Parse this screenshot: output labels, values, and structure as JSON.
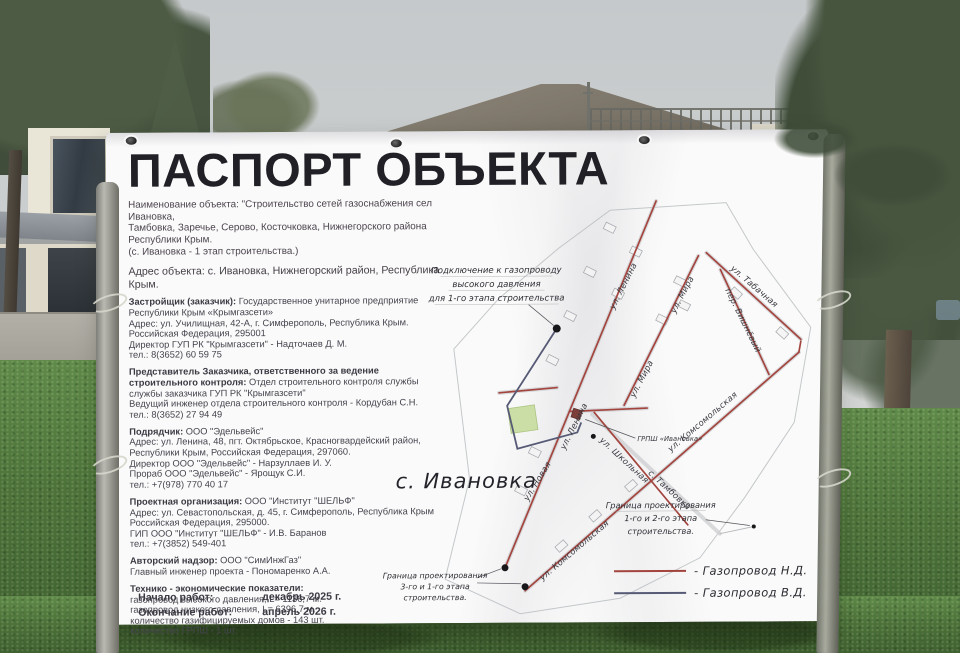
{
  "banner": {
    "title": "ПАСПОРТ ОБЪЕКТА",
    "object_name": {
      "l1": "Наименование объекта: \"Строительство сетей газоснабжения сел Ивановка,",
      "l2": "Тамбовка, Заречье, Серово, Косточковка, Нижнегорского района Республики Крым.",
      "l3": "(с. Ивановка - 1 этап строительства.)"
    },
    "address": "Адрес объекта: с. Ивановка, Нижнегорский район, Республика Крым.",
    "s1": {
      "bold": "Застройщик (заказчик):",
      "rest": " Государственное унитарное предприятие",
      "lines": [
        "Республики Крым «Крымгазсети»",
        "Адрес: ул. Училищная, 42-А, г. Симферополь, Республика Крым.",
        "Российская Федерация, 295001",
        "Директор ГУП РК \"Крымгазсети\" - Надточаев Д. М.",
        "тел.: 8(3652) 60 59 75"
      ]
    },
    "s2": {
      "bold1": "Представитель Заказчика, ответственного за ведение",
      "bold2": "строительного контроля:",
      "rest": " Отдел строительного контроля службы",
      "lines": [
        "службы заказчика ГУП РК \"Крымгазсети\"",
        "Ведущий инженер отдела строительного контроля - Кордубан С.Н.",
        "тел.: 8(3652) 27 94 49"
      ]
    },
    "s3": {
      "bold": "Подрядчик:",
      "rest": " ООО \"Эдельвейс\"",
      "lines": [
        "Адрес: ул. Ленина, 48, пгт. Октябрьское, Красногвардейский район,",
        "Республики Крым, Российская Федерация, 297060.",
        "Директор ООО \"Эдельвейс\" - Нарзуллаев И. У.",
        "Прораб ООО \"Эдельвейс\" - Ярощук С.И.",
        "тел.: +7(978) 770 40 17"
      ]
    },
    "s4": {
      "bold": "Проектная организация:",
      "rest": " ООО \"Институт \"ШЕЛЬФ\"",
      "lines": [
        "Адрес: ул. Севастопольская, д. 45, г. Симферополь, Республика Крым",
        "Российская Федерация, 295000.",
        "ГИП ООО \"Институт \"ШЕЛЬФ\" - И.В. Баранов",
        "тел.: +7(3852) 549-401"
      ]
    },
    "s5": {
      "bold": "Авторский надзор:",
      "rest": " ООО \"СимИнжГаз\"",
      "lines": [
        "Главный инженер проекта - Пономаренко А.А."
      ]
    },
    "s6": {
      "bold": "Технико - экономические показатели:",
      "lines": [
        "газопровод высокого давления, L= 1136,7 м.",
        "газопровод низкого давления, L= 6396,7 м.",
        "количество газифицируемых домов - 143 шт.",
        "количество ГРПШ - 1 шт."
      ]
    },
    "dates": {
      "start_label": "Начало работ:",
      "start_value": "декабрь 2025 г.",
      "end_label": "Окончание работ:",
      "end_value": "апрель 2026 г."
    }
  },
  "map": {
    "connection_note": {
      "l1": "Подключение к газопроводу",
      "l2": "высокого давления",
      "l3": "для 1-го этапа строительства"
    },
    "village_label": "с. Ивановка",
    "grpsh_label": "ГРПШ «Ивановка»",
    "boundary_note_stage_1_2": {
      "l1": "Граница проектирования",
      "l2": "1-го и 2-го этапа",
      "l3": "строительства."
    },
    "boundary_note_stage_3_1": {
      "l1": "Граница проектирования",
      "l2": "3-го и 1-го этапа",
      "l3": "строительства."
    },
    "streets": {
      "lenina": "ул. Ленина",
      "mira": "ул. Мира",
      "tabachnaya": "ул. Табачная",
      "vishnevyy": "пер. Вишнёвый",
      "komsomolskaya": "ул. Комсомольская",
      "novaya": "ул. Новая",
      "shkolnaya": "ул. Школьная",
      "tambovka": "с. Тамбовка"
    },
    "legend": {
      "nd_label": "-  Газопровод Н.Д.",
      "vd_label": "-  Газопровод В.Д.",
      "nd_color": "#a3453e",
      "vd_color": "#565a75"
    }
  }
}
